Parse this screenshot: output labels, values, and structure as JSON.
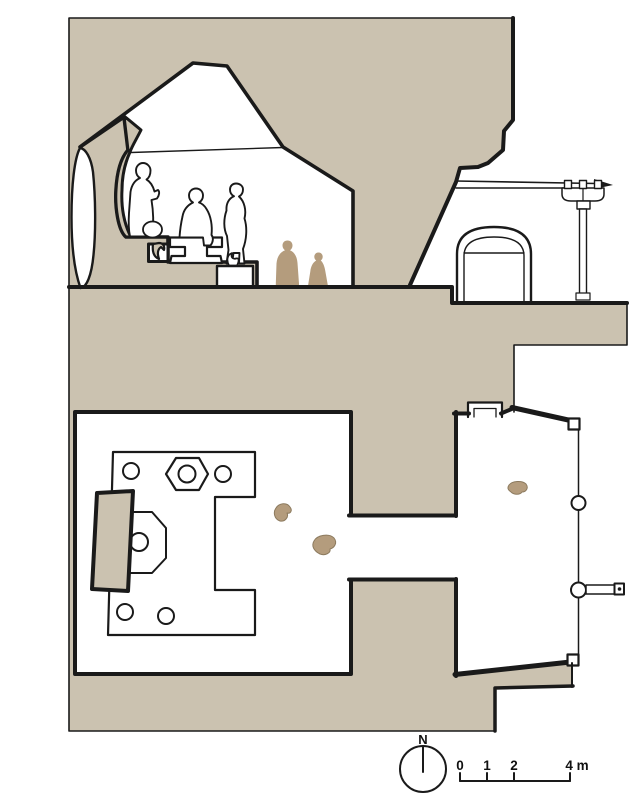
{
  "colors": {
    "rock": "#cbc2b0",
    "figure": "#b49c7d",
    "line": "#1a1a1a",
    "background": "#ffffff"
  },
  "compass": {
    "label": "N"
  },
  "scale_bar": {
    "tick_labels": [
      "0",
      "1",
      "2"
    ],
    "end_label": "4 m"
  }
}
